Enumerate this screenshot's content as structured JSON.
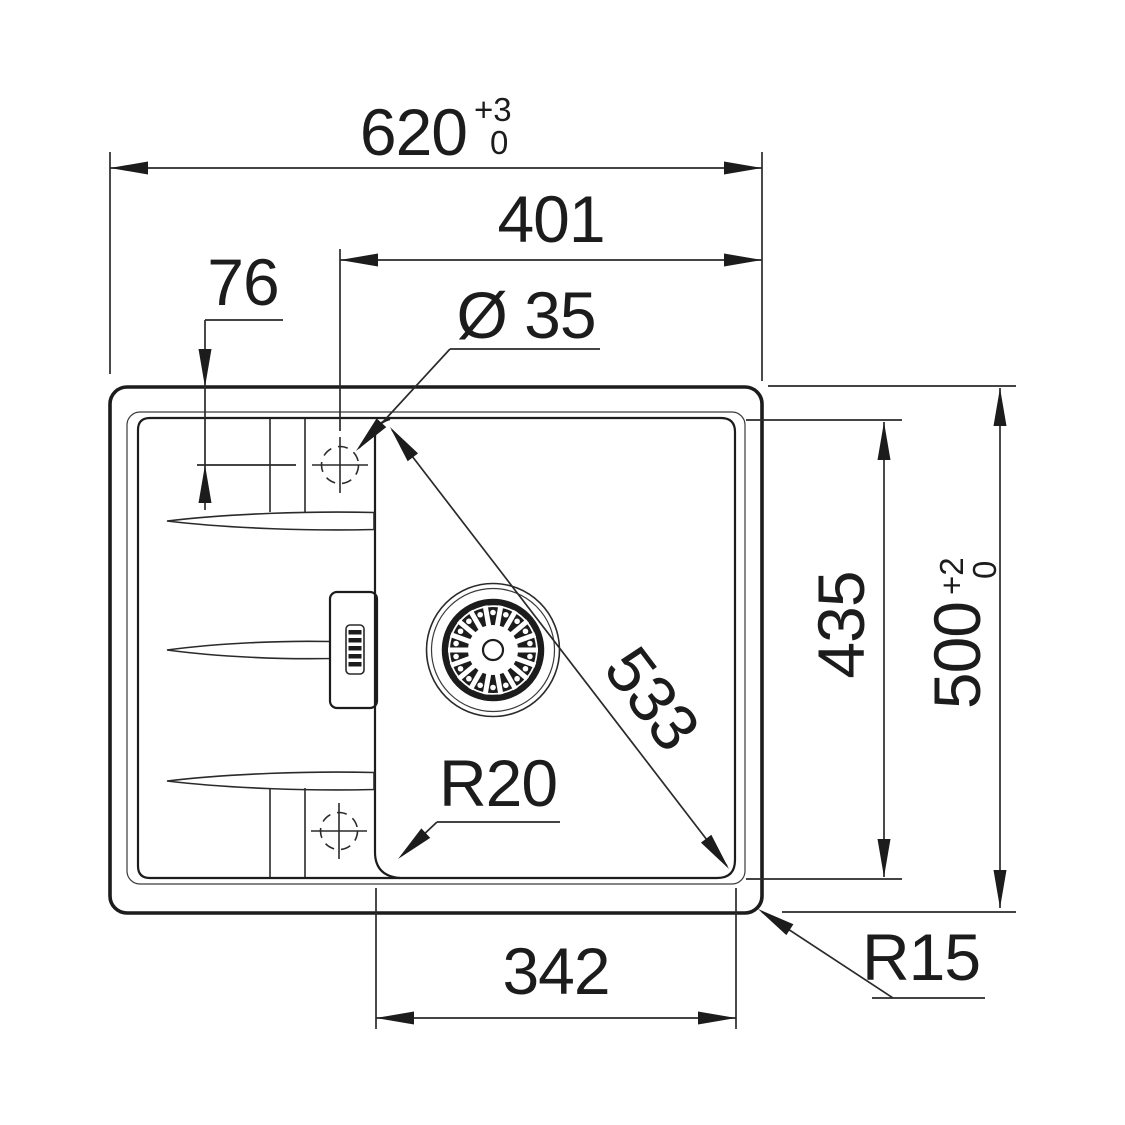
{
  "drawing": {
    "type": "sink-installation-technical-drawing",
    "line_color": "#1c1c1c",
    "background": "#ffffff",
    "dims": {
      "overall_width": {
        "value": "620",
        "tol_plus": "+3",
        "tol_zero": "0"
      },
      "hole_to_right": {
        "value": "401"
      },
      "edge_to_hole": {
        "value": "76"
      },
      "hole_diameter": {
        "value": "Ø 35"
      },
      "bowl_diagonal": {
        "value": "533"
      },
      "bowl_height": {
        "value": "435"
      },
      "overall_depth": {
        "value": "500",
        "tol_plus": "+2",
        "tol_zero": "0"
      },
      "bowl_width": {
        "value": "342"
      },
      "bowl_corner_radius": {
        "value": "R20"
      },
      "outer_corner_radius": {
        "value": "R15"
      }
    }
  }
}
